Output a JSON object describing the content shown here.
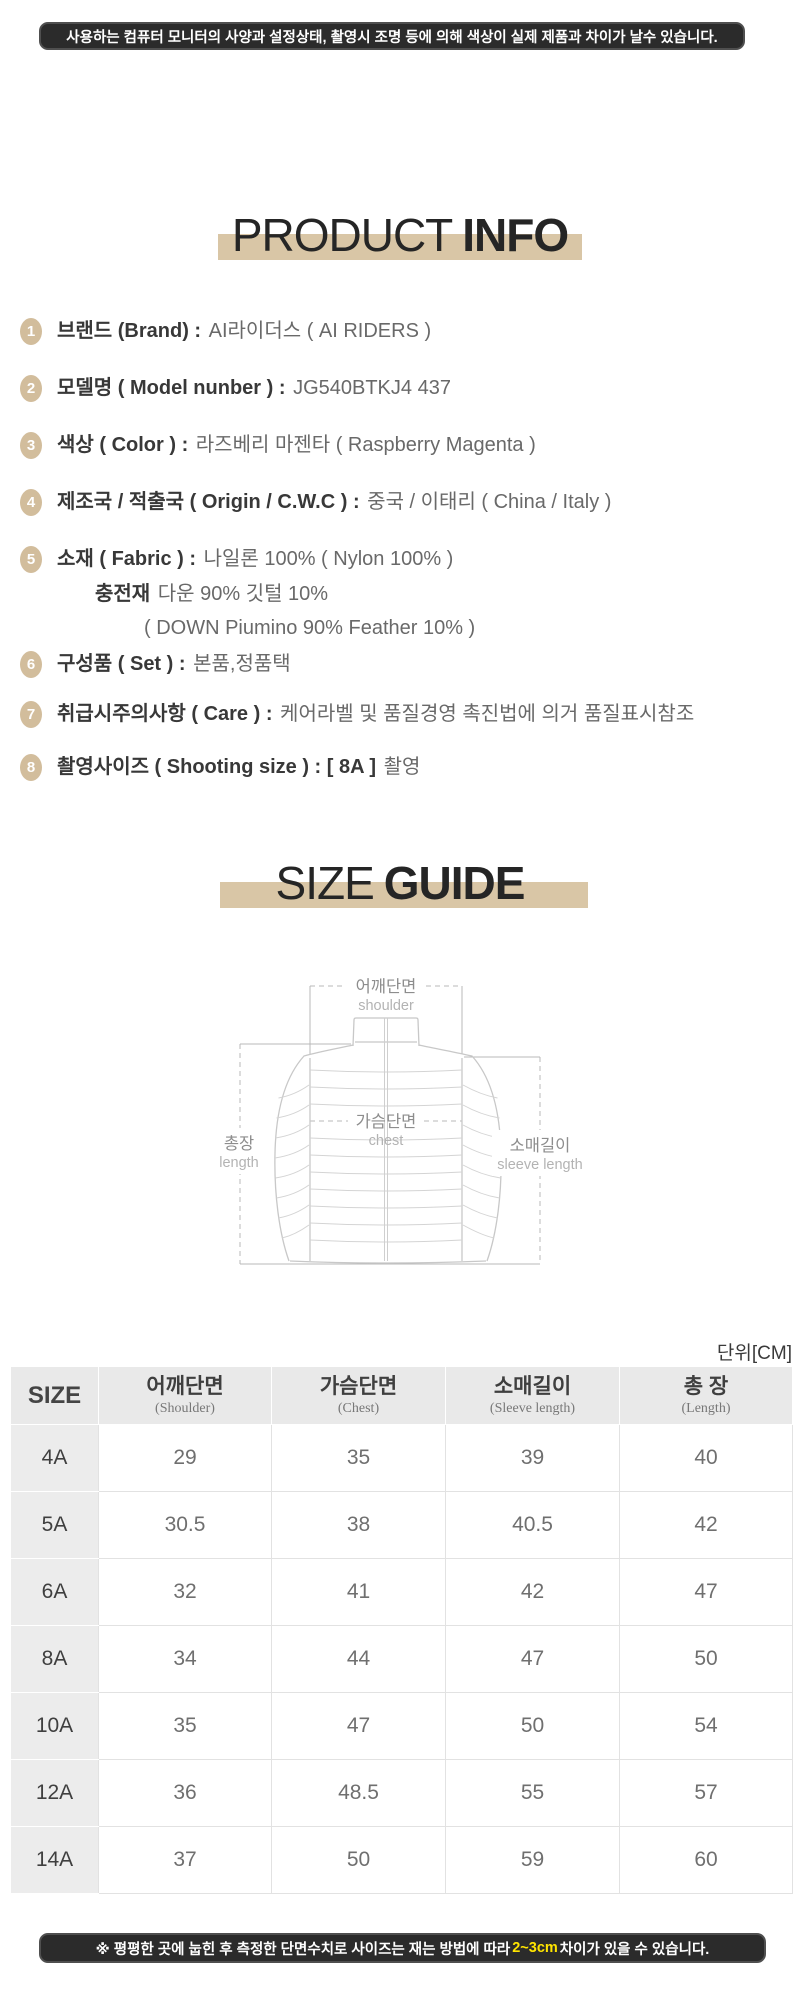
{
  "colors": {
    "accent_tan": "#d9c6a6",
    "badge_tan": "#d2bd9c",
    "banner_dark": "#2b2b2b",
    "highlight_yellow": "#ffe400"
  },
  "top_banner": {
    "text": "사용하는 컴퓨터 모니터의 사양과 설정상태, 촬영시 조명 등에 의해 색상이 실제 제품과 차이가 날수 있습니다."
  },
  "product_info": {
    "title_light": "PRODUCT",
    "title_bold": "INFO",
    "items": [
      {
        "num": "1",
        "label": "브랜드 (Brand) : ",
        "value": "AI라이더스 ( AI RIDERS )"
      },
      {
        "num": "2",
        "label": "모델명 ( Model nunber ) : ",
        "value": "JG540BTKJ4 437"
      },
      {
        "num": "3",
        "label": "색상 ( Color ) : ",
        "value": "라즈베리 마젠타 ( Raspberry Magenta )"
      },
      {
        "num": "4",
        "label": "제조국 / 적출국 ( Origin / C.W.C ) : ",
        "value": "중국 / 이태리 ( China /  Italy )"
      },
      {
        "num": "5",
        "label": "소재 ( Fabric ) : ",
        "value": "나일론 100% ( Nylon 100% )",
        "sub": [
          {
            "bold": "충전재",
            "text": " 다운 90% 깃털 10%"
          },
          {
            "bold": "",
            "text": "( DOWN Piumino 90% Feather 10% )"
          }
        ]
      },
      {
        "num": "6",
        "label": "구성품 ( Set ) : ",
        "value": "본품,정품택"
      },
      {
        "num": "7",
        "label": "취급시주의사항 ( Care ) : ",
        "value": "케어라벨 및 품질경영 촉진법에 의거 품질표시참조"
      },
      {
        "num": "8",
        "label": "촬영사이즈 ( Shooting size ) : ",
        "value_bold": "[ 8A ]",
        "value": " 촬영"
      }
    ]
  },
  "size_guide": {
    "title_light": "SIZE",
    "title_bold": "GUIDE",
    "diagram": {
      "shoulder_ko": "어깨단면",
      "shoulder_en": "shoulder",
      "chest_ko": "가슴단면",
      "chest_en": "chest",
      "length_ko": "총장",
      "length_en": "length",
      "sleeve_ko": "소매길이",
      "sleeve_en": "sleeve length"
    },
    "unit_label": "단위[CM]",
    "table": {
      "headers": [
        {
          "ko": "SIZE",
          "en": ""
        },
        {
          "ko": "어깨단면",
          "en": "(Shoulder)"
        },
        {
          "ko": "가슴단면",
          "en": "(Chest)"
        },
        {
          "ko": "소매길이",
          "en": "(Sleeve length)"
        },
        {
          "ko": "총 장",
          "en": "(Length)"
        }
      ],
      "rows": [
        {
          "size": "4A",
          "values": [
            "29",
            "35",
            "39",
            "40"
          ]
        },
        {
          "size": "5A",
          "values": [
            "30.5",
            "38",
            "40.5",
            "42"
          ]
        },
        {
          "size": "6A",
          "values": [
            "32",
            "41",
            "42",
            "47"
          ]
        },
        {
          "size": "8A",
          "values": [
            "34",
            "44",
            "47",
            "50"
          ]
        },
        {
          "size": "10A",
          "values": [
            "35",
            "47",
            "50",
            "54"
          ]
        },
        {
          "size": "12A",
          "values": [
            "36",
            "48.5",
            "55",
            "57"
          ]
        },
        {
          "size": "14A",
          "values": [
            "37",
            "50",
            "59",
            "60"
          ]
        }
      ]
    }
  },
  "bottom_banner": {
    "prefix": "※ 평평한 곳에 눕힌 후 측정한 단면수치로 사이즈는 재는 방법에 따라 ",
    "highlight": "2~3cm",
    "suffix": "차이가 있을 수 있습니다."
  }
}
